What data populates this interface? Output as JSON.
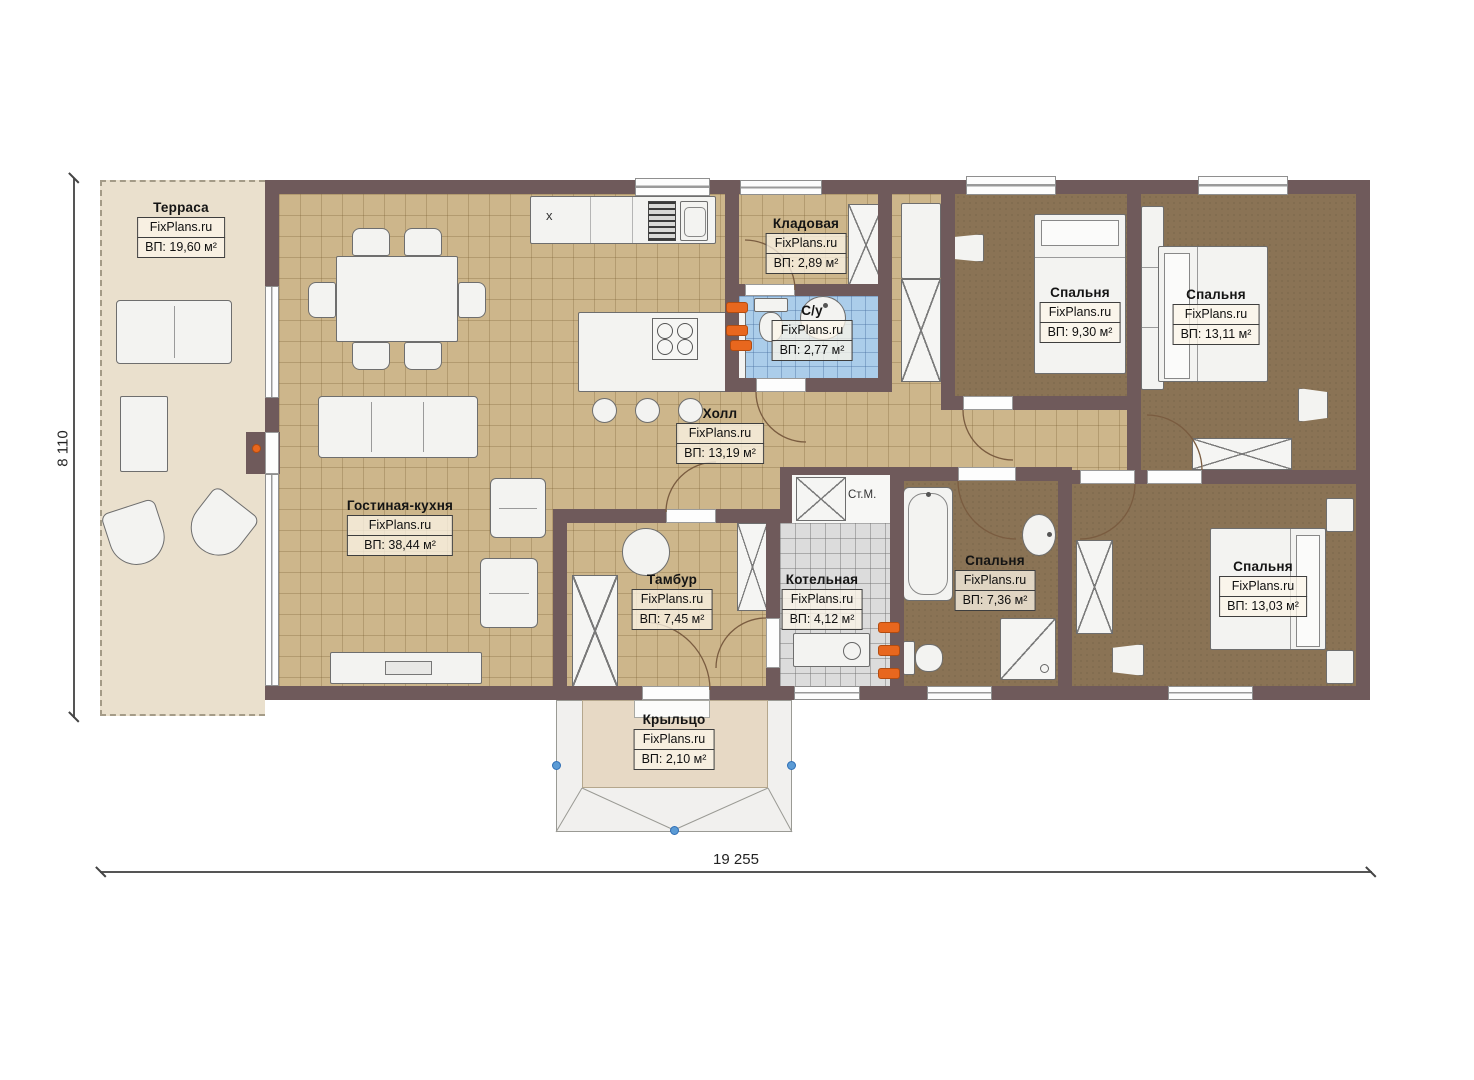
{
  "plan": {
    "watermark": "FixPlans.ru",
    "dimensions": {
      "width": "19 255",
      "height": "8 110"
    },
    "annotations": {
      "washing_machine": "Ст.М.",
      "counter_marker": "x"
    },
    "rooms": [
      {
        "id": "terrace",
        "name": "Терраса",
        "area": "ВП: 19,60 м²"
      },
      {
        "id": "living-kitchen",
        "name": "Гостиная-кухня",
        "area": "ВП: 38,44 м²"
      },
      {
        "id": "storage",
        "name": "Кладовая",
        "area": "ВП: 2,89 м²"
      },
      {
        "id": "wc",
        "name": "С/у",
        "area": "ВП: 2,77 м²"
      },
      {
        "id": "hall",
        "name": "Холл",
        "area": "ВП: 13,19 м²"
      },
      {
        "id": "bedroom-1",
        "name": "Спальня",
        "area": "ВП: 9,30 м²"
      },
      {
        "id": "bedroom-2",
        "name": "Спальня",
        "area": "ВП: 13,11 м²"
      },
      {
        "id": "vestibule",
        "name": "Тамбур",
        "area": "ВП: 7,45 м²"
      },
      {
        "id": "boiler-room",
        "name": "Котельная",
        "area": "ВП: 4,12 м²"
      },
      {
        "id": "bedroom-3",
        "name": "Спальня",
        "area": "ВП: 7,36 м²"
      },
      {
        "id": "bedroom-4",
        "name": "Спальня",
        "area": "ВП: 13,03 м²"
      },
      {
        "id": "porch",
        "name": "Крыльцо",
        "area": "ВП: 2,10 м²"
      }
    ],
    "colors": {
      "wall": "#6f5a5b",
      "tile_floor": "#cdb68b",
      "bedroom_floor": "#8a7355",
      "wet_floor": "#abcdea",
      "boiler_floor": "#dcdcdc",
      "terrace_floor": "#eae0cd",
      "radiator": "#e8671e",
      "handle": "#5b9bd5"
    }
  }
}
